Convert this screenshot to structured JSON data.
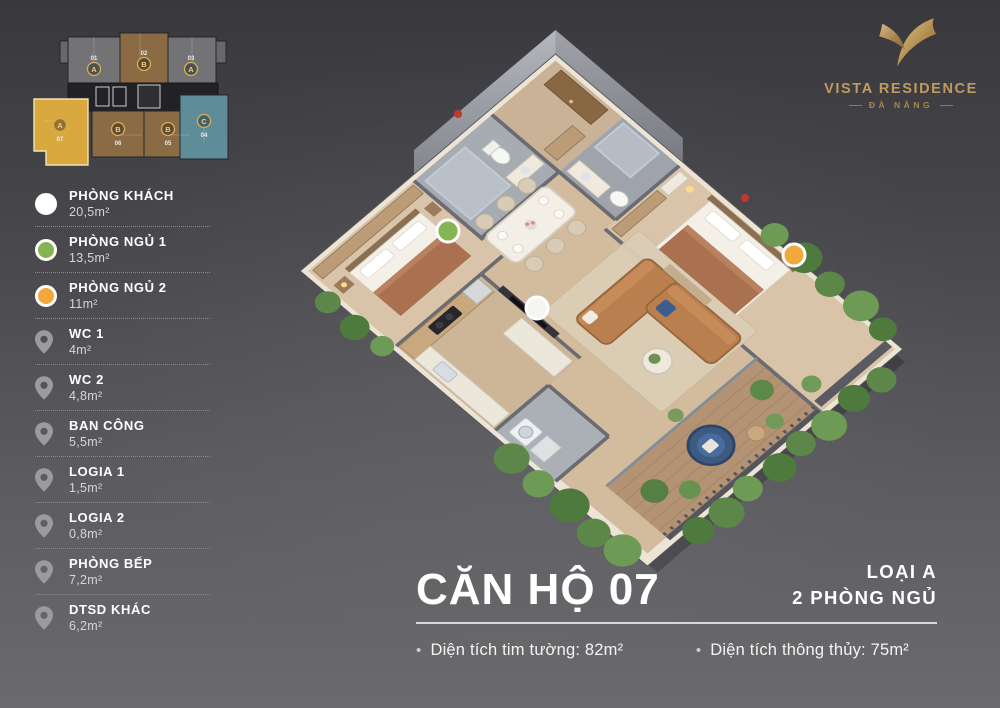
{
  "brand": {
    "name": "VISTA RESIDENCE",
    "location": "ĐÀ NẴNG"
  },
  "miniplan": {
    "units": [
      {
        "number": "01",
        "letter": "A"
      },
      {
        "number": "02",
        "letter": "B"
      },
      {
        "number": "03",
        "letter": "A"
      },
      {
        "number": "04",
        "letter": "C"
      },
      {
        "number": "05",
        "letter": "B"
      },
      {
        "number": "06",
        "letter": "B"
      },
      {
        "number": "07",
        "letter": "A",
        "highlighted": true
      }
    ]
  },
  "legend": {
    "items": [
      {
        "name": "PHÒNG KHÁCH",
        "area": "20,5m²",
        "icon": "circle",
        "color": "#ffffff"
      },
      {
        "name": "PHÒNG NGỦ 1",
        "area": "13,5m²",
        "icon": "circle",
        "color": "#84b552"
      },
      {
        "name": "PHÒNG NGỦ 2",
        "area": "11m²",
        "icon": "circle",
        "color": "#f2a93b"
      },
      {
        "name": "WC 1",
        "area": "4m²",
        "icon": "pin",
        "color": "#9b9b9e"
      },
      {
        "name": "WC 2",
        "area": "4,8m²",
        "icon": "pin",
        "color": "#9b9b9e"
      },
      {
        "name": "BAN CÔNG",
        "area": "5,5m²",
        "icon": "pin",
        "color": "#9b9b9e"
      },
      {
        "name": "LOGIA 1",
        "area": "1,5m²",
        "icon": "pin",
        "color": "#9b9b9e"
      },
      {
        "name": "LOGIA 2",
        "area": "0,8m²",
        "icon": "pin",
        "color": "#9b9b9e"
      },
      {
        "name": "PHÒNG BẾP",
        "area": "7,2m²",
        "icon": "pin",
        "color": "#9b9b9e"
      },
      {
        "name": "DTSD KHÁC",
        "area": "6,2m²",
        "icon": "pin",
        "color": "#9b9b9e"
      }
    ]
  },
  "apartment": {
    "title": "CĂN HỘ 07",
    "type_line1": "LOẠI A",
    "type_line2": "2 PHÒNG NGỦ",
    "stats": [
      {
        "text": "Diện tích tim tường: 82m²"
      },
      {
        "text": "Diện tích thông thủy: 75m²"
      }
    ]
  },
  "colors": {
    "background_top": "#38383d",
    "background_bottom": "#6b6b6e",
    "brand_gold": "#bf9a61",
    "legend_green": "#84b552",
    "legend_yellow": "#f2a93b",
    "unit_highlight": "#d9a83f",
    "unit_brown": "#8b6b44",
    "unit_gray": "#737376",
    "unit_teal": "#5e8d99"
  }
}
